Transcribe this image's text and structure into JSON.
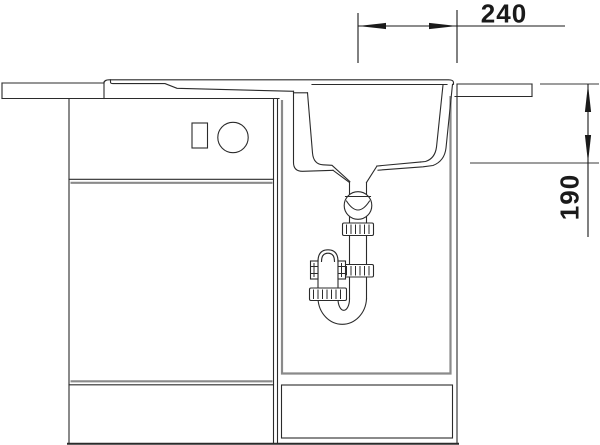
{
  "drawing": {
    "subject": "kitchen-sink-base-cabinet-side-section",
    "colors": {
      "background": "#ffffff",
      "line": "#2b2b2b",
      "door_outline_gray": "#8a8a8a",
      "dimension_text": "#1a1a1a"
    },
    "dimensions": {
      "width_240": {
        "value": "240",
        "orientation": "horizontal"
      },
      "depth_190": {
        "value": "190",
        "orientation": "vertical"
      }
    }
  }
}
